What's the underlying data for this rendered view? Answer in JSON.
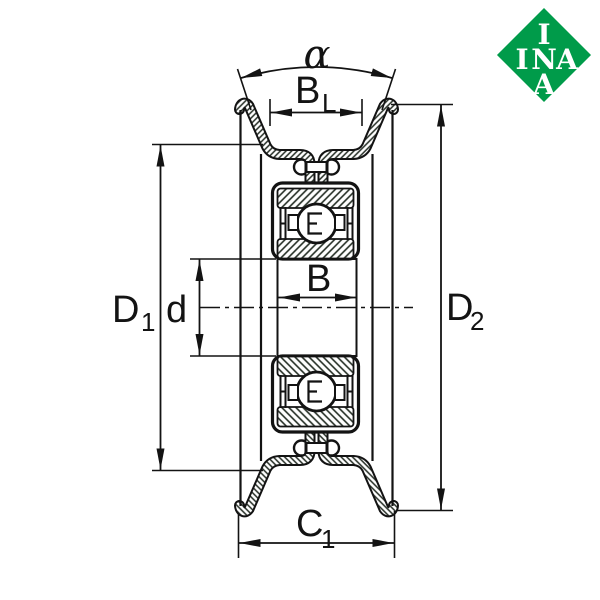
{
  "drawing": {
    "description_labels": {
      "alpha": "α",
      "groove_width_main": "B",
      "groove_width_sub": "L",
      "bearing_width": "B",
      "bore": "d",
      "d1_main": "D",
      "d1_sub": "1",
      "d2_main": "D",
      "d2_sub": "2",
      "c1_main": "C",
      "c1_sub": "1"
    },
    "colors": {
      "line": "#131313",
      "hatch": "#242d24",
      "background": "#ffffff",
      "logo_green": "#009b4a",
      "logo_text": "#ffffff"
    }
  },
  "logo": {
    "bg_color": "#009b4a",
    "top": "I",
    "mid_i": "I",
    "mid_n": "N",
    "mid_a": "A",
    "bottom": "A"
  }
}
